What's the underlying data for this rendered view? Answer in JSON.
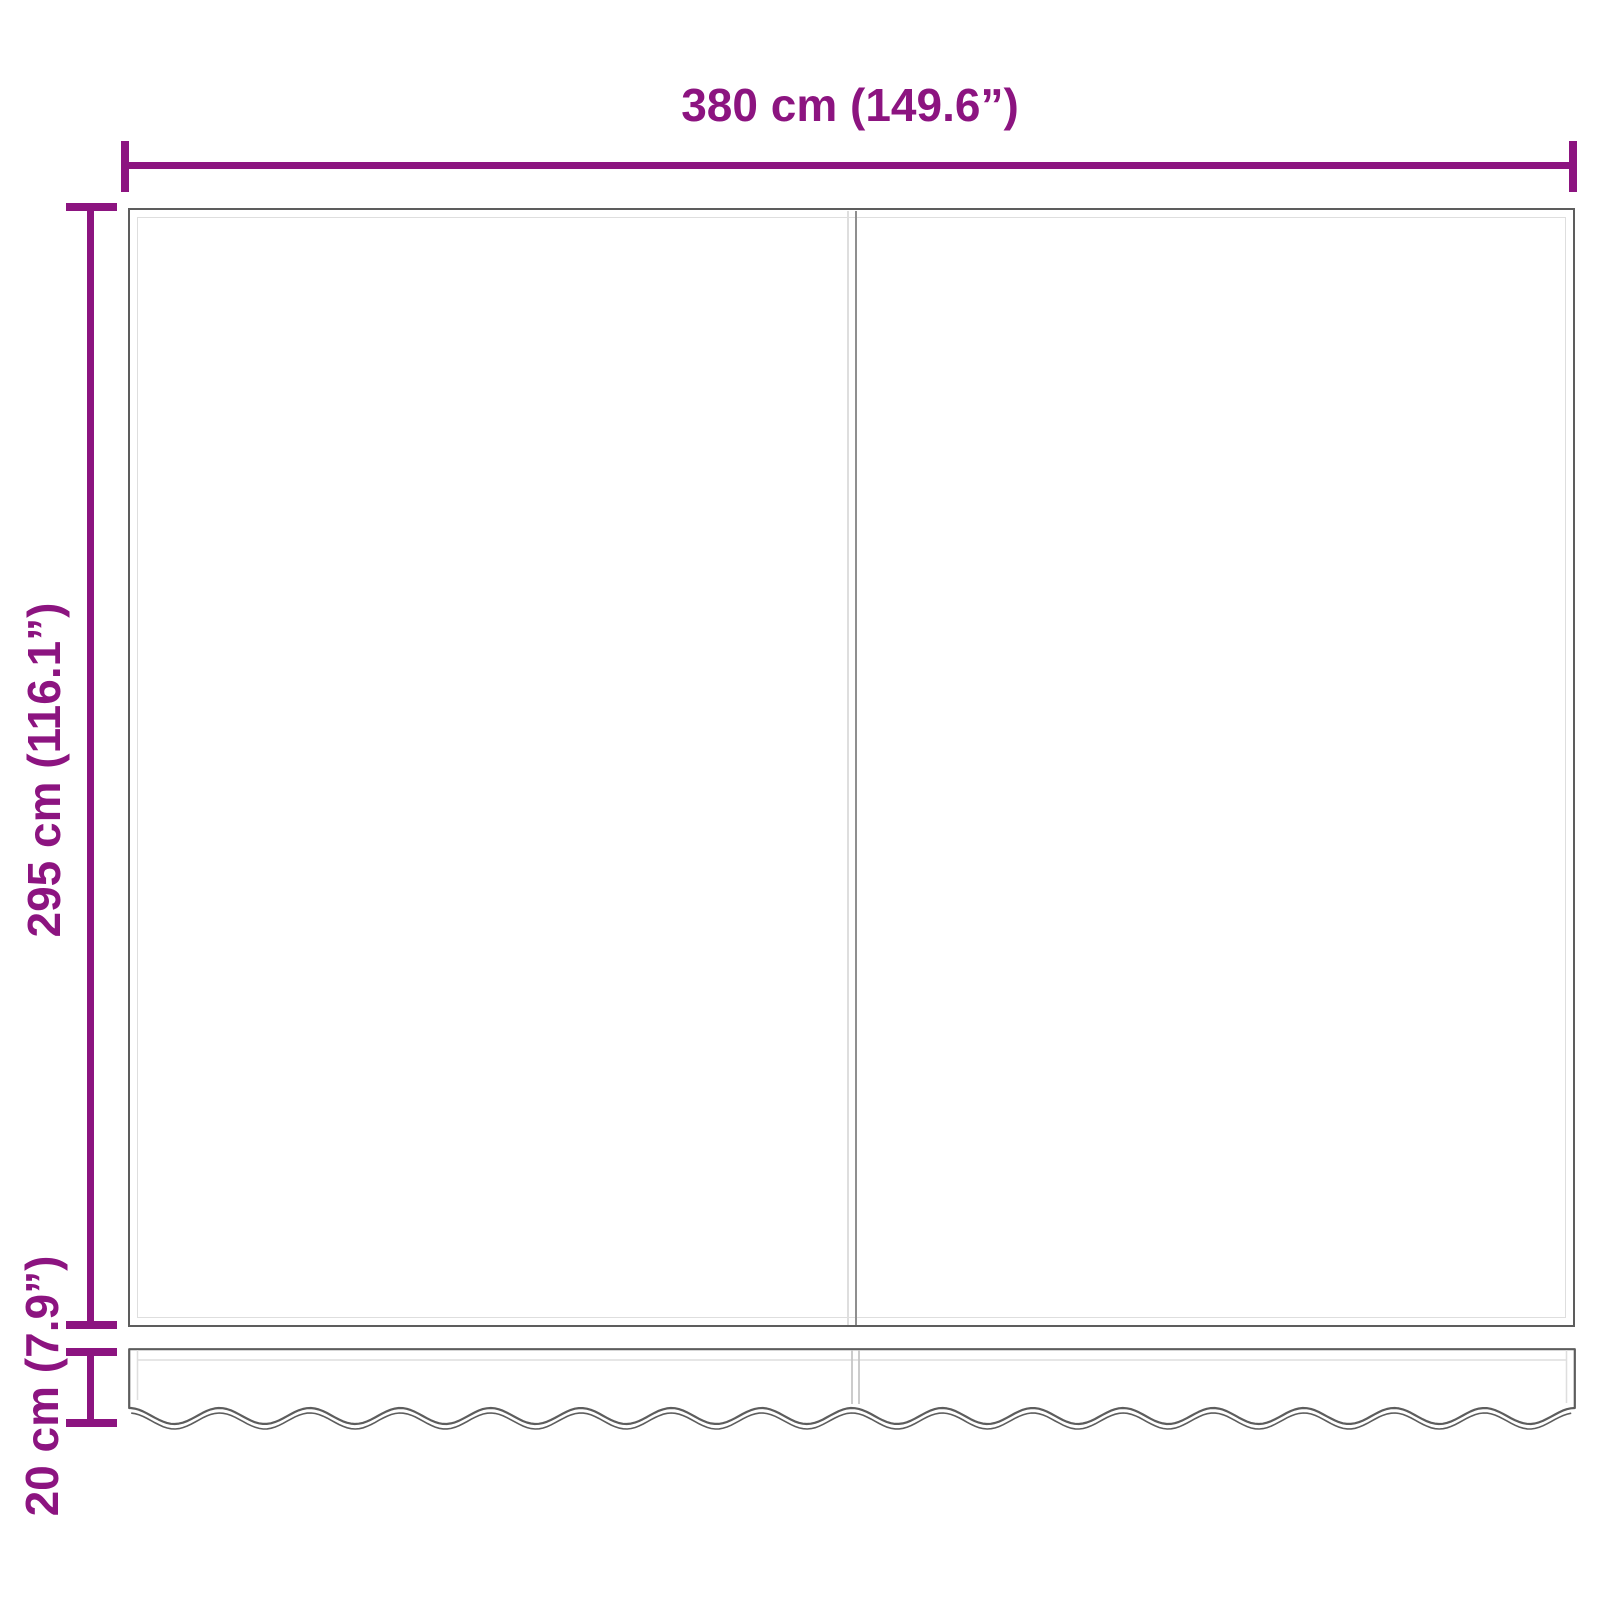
{
  "diagram": {
    "title": "awning-fabric-dimension-diagram",
    "labels": {
      "width": "380 cm (149.6”)",
      "height": "295 cm (116.1”)",
      "valance_height": "20 cm (7.9”)"
    },
    "colors": {
      "dimension": "#8c1480",
      "outline_dark": "#5d5d5d",
      "hem_light": "#dedede",
      "seam_mid": "#8f8f8f",
      "background": "#ffffff"
    },
    "parts": {
      "main_panel": "fabric panel with center seam and hem border",
      "valance": "scalloped wavy valance strip"
    }
  }
}
